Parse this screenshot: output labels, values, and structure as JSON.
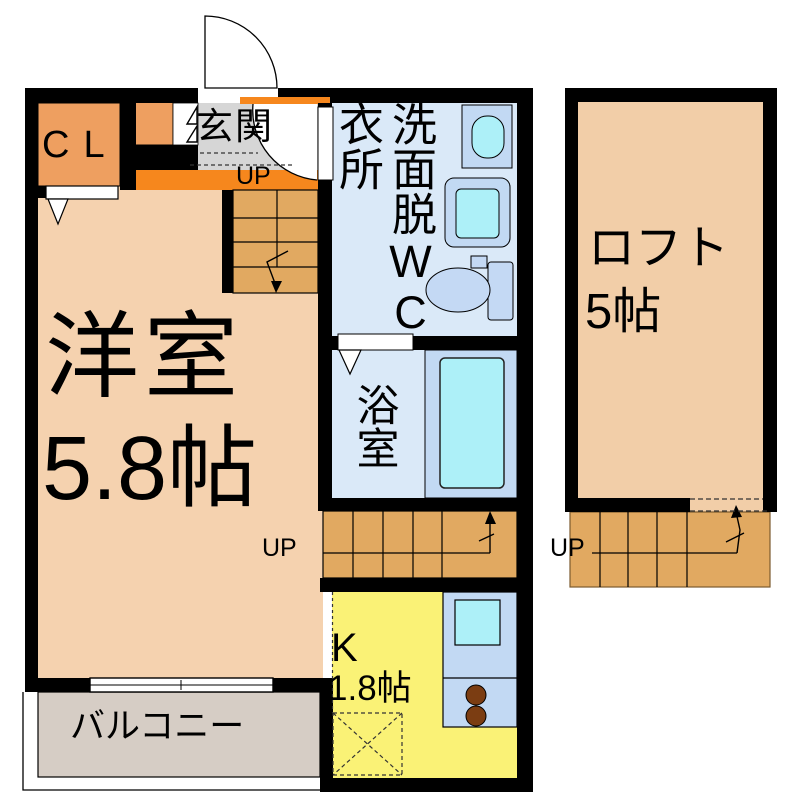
{
  "title": "apartment-floor-plan",
  "labels": {
    "closet": "CL",
    "entrance": "玄関",
    "up": "UP",
    "washroom_left_column": "衣所",
    "washroom_right_column": "洗面脱WC",
    "bathroom": "浴室",
    "main_room_name": "洋室",
    "main_room_size": "5.8帖",
    "kitchen_name": "K",
    "kitchen_size": "1.8帖",
    "balcony": "バルコニー",
    "loft_name": "ロフト",
    "loft_size": "5帖"
  },
  "colors": {
    "wall": "#000000",
    "room_tan": "#F5D2AF",
    "loft_tan": "#F2CEA8",
    "closet_orange": "#EE9F60",
    "hall_orange": "#F6871D",
    "stair_tan": "#E1A961",
    "genkan_gray": "#D6D6D6",
    "wet_blue": "#DAE9F8",
    "fixture_blue": "#C2D9F3",
    "fixture_cyan": "#ADF0F8",
    "toilet_blue": "#C4D9F4",
    "kitchen_yellow": "#FAF276",
    "balcony_gray": "#D6CDC5",
    "burner_brown": "#7B3D12"
  }
}
